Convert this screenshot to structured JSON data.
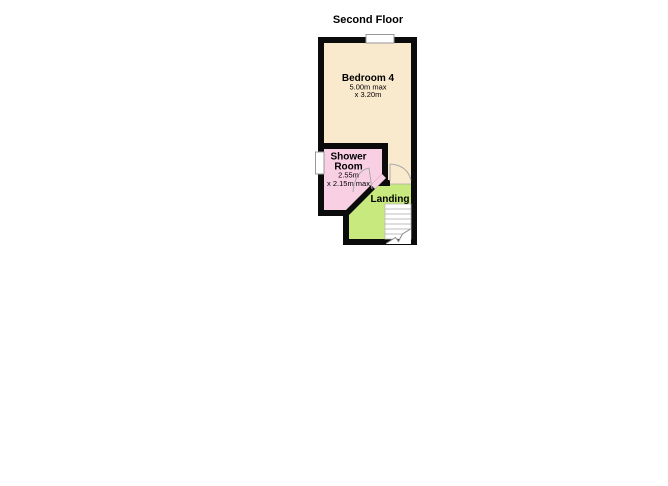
{
  "title": "Second Floor",
  "rooms": {
    "bedroom": {
      "name": "Bedroom 4",
      "dim1": "5.00m max",
      "dim2": "x 3.20m",
      "color": "#F9E9CD"
    },
    "shower_room": {
      "name_line1": "Shower",
      "name_line2": "Room",
      "dim1": "2.55m",
      "dim2": "x 2.15m max",
      "color": "#F9CFE4"
    },
    "landing": {
      "name": "Landing",
      "color": "#C7E97D"
    }
  },
  "colors": {
    "wall": "#0B0B0B",
    "background": "#FFFFFF",
    "window_fill": "#FFFFFF",
    "window_border": "#999999",
    "door_line": "#AAAAAA",
    "stair_line": "#AAAAAA",
    "stair_fill": "#FFFFFF",
    "text": "#000000"
  }
}
